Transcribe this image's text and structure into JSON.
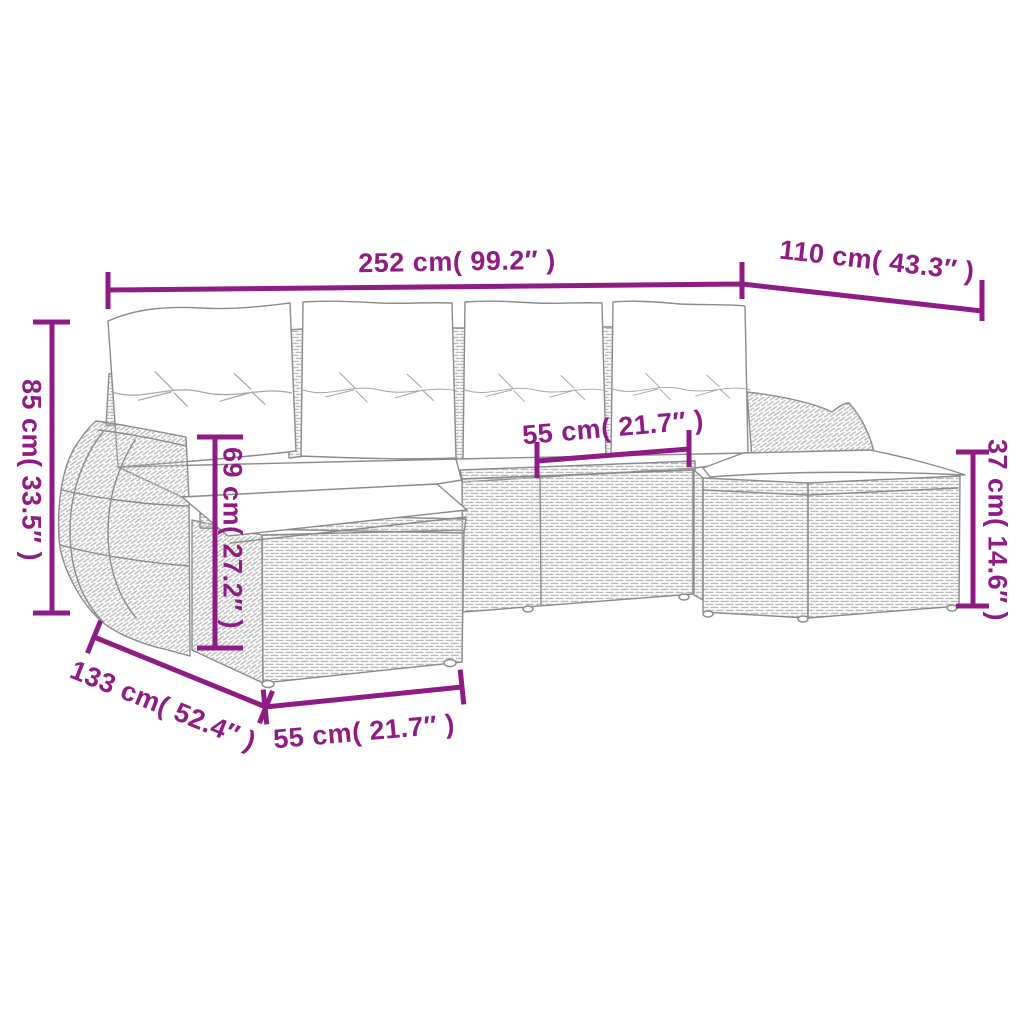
{
  "colors": {
    "accent": "#8E1C84",
    "line_art": "#8b8b8b",
    "background": "#ffffff"
  },
  "diagram": {
    "subject": "6-piece rattan garden lounge set with cushions - dimension line drawing",
    "dimensions": {
      "overall_width": {
        "label": "252 cm( 99.2″ )"
      },
      "right_depth": {
        "label": "110 cm( 43.3″ )"
      },
      "back_height": {
        "label": "85 cm( 33.5″ )"
      },
      "seat_front_height": {
        "label": "69 cm( 27.2″ )"
      },
      "seat_width": {
        "label": "55 cm( 21.7″ )"
      },
      "stool_height": {
        "label": "37 cm( 14.6″ )"
      },
      "left_depth": {
        "label": "133 cm( 52.4″ )"
      },
      "stool_width": {
        "label": "55 cm( 21.7″ )"
      }
    }
  }
}
